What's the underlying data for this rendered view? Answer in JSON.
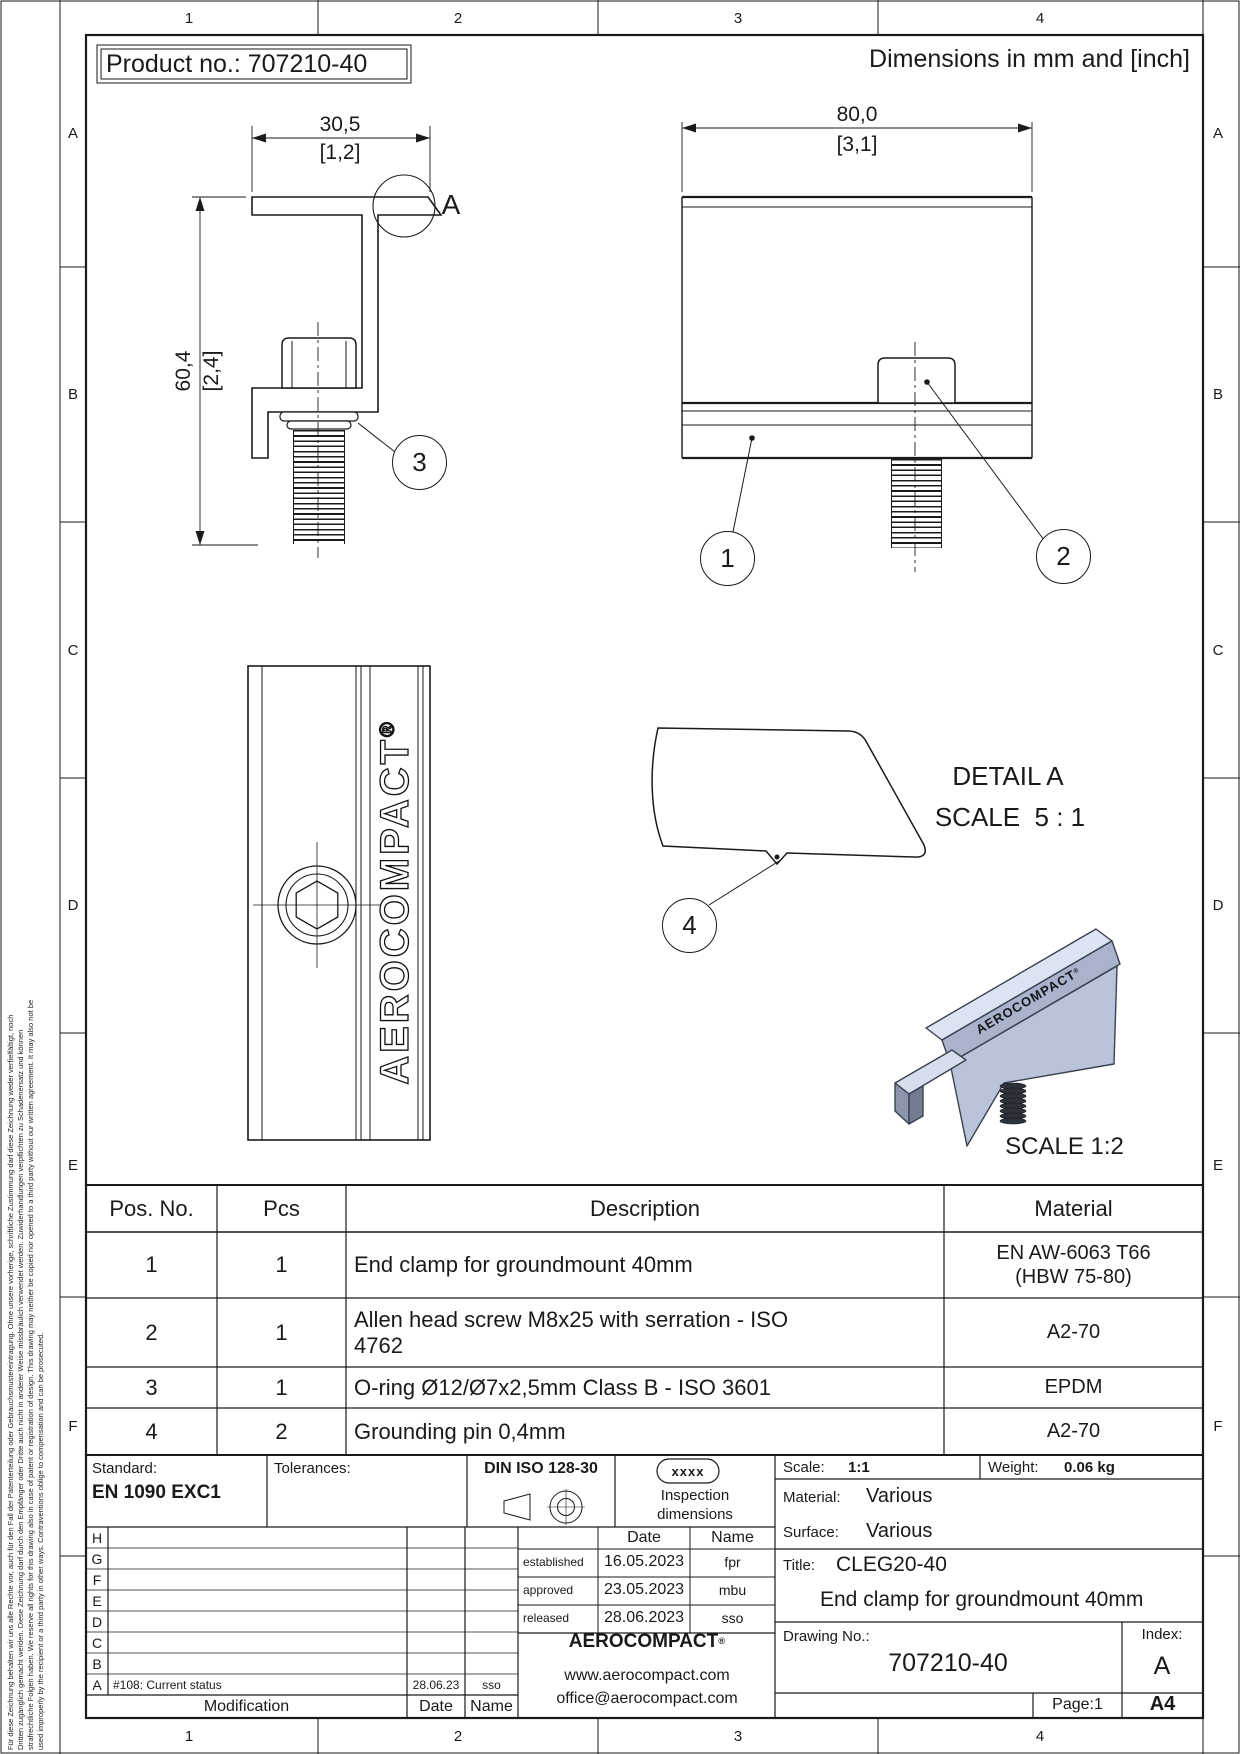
{
  "sheet": {
    "product_no": "Product no.: 707210-40",
    "dimensions_note": "Dimensions in mm and [inch]",
    "zone_columns": [
      "1",
      "2",
      "3",
      "4"
    ],
    "zone_rows": [
      "A",
      "B",
      "C",
      "D",
      "E",
      "F"
    ]
  },
  "views": {
    "side_view": {
      "width_mm": "30,5",
      "width_inch": "[1,2]",
      "height_mm": "60,4",
      "height_inch": "[2,4]",
      "detail_label": "A",
      "balloon_oring": "3"
    },
    "front_view": {
      "width_mm": "80,0",
      "width_inch": "[3,1]",
      "balloon_clamp": "1",
      "balloon_screw": "2"
    },
    "top_view": {
      "logo": "AEROCOMPACT",
      "mark": "®"
    },
    "detail_a": {
      "title": "DETAIL A",
      "scale": "SCALE  5 : 1",
      "balloon_pin": "4"
    },
    "iso_view": {
      "logo": "AEROCOMPACT",
      "mark": "®",
      "scale": "SCALE 1:2"
    }
  },
  "parts_table": {
    "headers": {
      "pos": "Pos. No.",
      "pcs": "Pcs",
      "description": "Description",
      "material": "Material"
    },
    "rows": [
      {
        "pos": "1",
        "pcs": "1",
        "description": "End clamp for groundmount 40mm",
        "material": "EN AW-6063 T66\n(HBW 75-80)"
      },
      {
        "pos": "2",
        "pcs": "1",
        "description": "Allen head screw M8x25 with serration - ISO 4762",
        "material": "A2-70"
      },
      {
        "pos": "3",
        "pcs": "1",
        "description": "O-ring Ø12/Ø7x2,5mm Class B - ISO 3601",
        "material": "EPDM"
      },
      {
        "pos": "4",
        "pcs": "2",
        "description": "Grounding pin 0,4mm",
        "material": "A2-70"
      }
    ]
  },
  "title_block": {
    "standard_label": "Standard:",
    "standard_value": "EN 1090 EXC1",
    "tolerances_label": "Tolerances:",
    "din_label": "DIN ISO 128-30",
    "inspection_code": "xxxx",
    "inspection_line1": "Inspection",
    "inspection_line2": "dimensions",
    "approval": {
      "date_header": "Date",
      "name_header": "Name",
      "established_label": "established",
      "established_date": "16.05.2023",
      "established_name": "fpr",
      "approved_label": "approved",
      "approved_date": "23.05.2023",
      "approved_name": "mbu",
      "released_label": "released",
      "released_date": "28.06.2023",
      "released_name": "sso"
    },
    "scale_label": "Scale:",
    "scale_value": "1:1",
    "weight_label": "Weight:",
    "weight_value": "0.06 kg",
    "material_label": "Material:",
    "material_value": "Various",
    "surface_label": "Surface:",
    "surface_value": "Various",
    "title_label": "Title:",
    "title_value": "CLEG20-40",
    "title_line2": "End clamp for groundmount 40mm",
    "drawing_no_label": "Drawing No.:",
    "drawing_no_value": "707210-40",
    "index_label": "Index:",
    "index_value": "A",
    "page": "Page:1",
    "format": "A4",
    "company": {
      "name": "AEROCOMPACT",
      "mark": "®",
      "website": "www.aerocompact.com",
      "email": "office@aerocompact.com"
    },
    "revisions": {
      "letters": [
        "H",
        "G",
        "F",
        "E",
        "D",
        "C",
        "B",
        "A"
      ],
      "row_a_modification": "#108: Current status",
      "row_a_date": "28.06.23",
      "row_a_name": "sso",
      "footer_modification": "Modification",
      "footer_date": "Date",
      "footer_name": "Name"
    }
  },
  "disclaimer": {
    "line1": "Für diese Zeichnung behalten wir uns alle Rechte vor, auch für den Fall der Patenterteilung oder Gebrauchsmustereintragung. Ohne unsere vorherige, schriftliche Zustimmung darf diese Zeichnung weder verfielfältigt, noch",
    "line2": "Dritten zugänglich gemacht werden. Diese Zeichnung darf durch den Empfänger oder Dritte auch nicht in anderer Weise missbräulich verwendet werden. Zuwiderhandlungen verpflichten zu Schadenersatz und können",
    "line3": "strafrechtliche Folgen haben. We reserve all rights for this drawing also in case of patent or registration of design. This drawing may neither be copied nor opened to a third party without our written agreement. It may also not be",
    "line4": "used improperly by the recipient or a third party in other ways. Contraventions oblige to compensation and can be prosecuted."
  }
}
